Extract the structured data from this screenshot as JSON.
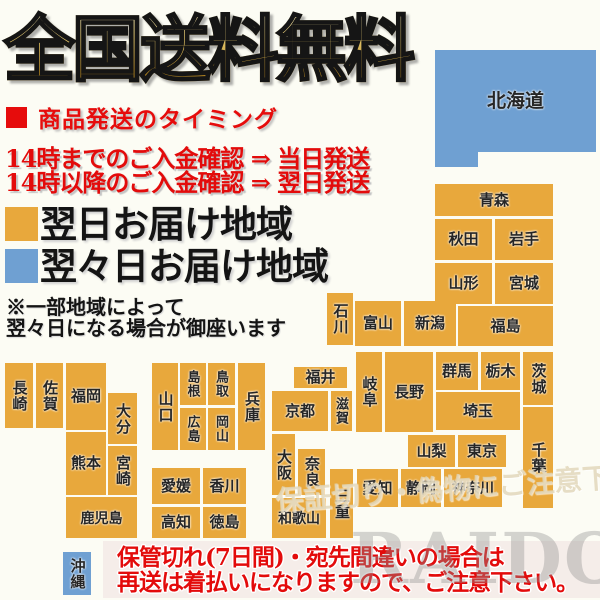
{
  "title": "全国送料無料",
  "shipping": {
    "header": "商品発送のタイミング",
    "lines": [
      "14時までのご入金確認 ⇒ 当日発送",
      "14時以降のご入金確認 ⇒ 翌日発送"
    ]
  },
  "legend": {
    "next_day": {
      "label": "翌日お届け地域",
      "color": "#E8A83C"
    },
    "two_days": {
      "label": "翌々日お届け地域",
      "color": "#6FA0D2"
    }
  },
  "note": {
    "line1": "※一部地域によって",
    "line2": "翌々日になる場合が御座います"
  },
  "warning": {
    "line1": "保管切れ(7日間)・宛先間違いの場合は",
    "line2": "再送は着払いになりますので、ご注意下さい。"
  },
  "watermarks": {
    "caution": "保証切り・偽物にご注意下さい",
    "brand": "RAIDOU"
  },
  "colors": {
    "orange": "#E8A83C",
    "blue": "#6FA0D2",
    "background": "#FCFCF4",
    "red": "#E30B0B"
  },
  "map": {
    "blocks": [
      {
        "id": "hokkaido",
        "label": "北海道",
        "x": 435,
        "y": 50,
        "w": 161,
        "h": 102,
        "c": "blue",
        "fs": 19
      },
      {
        "id": "hokkaido-leg",
        "label": "",
        "x": 435,
        "y": 150,
        "w": 43,
        "h": 17,
        "c": "blue"
      },
      {
        "id": "aomori",
        "label": "青森",
        "x": 435,
        "y": 184,
        "w": 118,
        "h": 32,
        "c": "orange"
      },
      {
        "id": "akita",
        "label": "秋田",
        "x": 435,
        "y": 219,
        "w": 57,
        "h": 41,
        "c": "orange"
      },
      {
        "id": "iwate",
        "label": "岩手",
        "x": 495,
        "y": 219,
        "w": 58,
        "h": 41,
        "c": "orange"
      },
      {
        "id": "yamagata",
        "label": "山形",
        "x": 435,
        "y": 263,
        "w": 57,
        "h": 41,
        "c": "orange"
      },
      {
        "id": "miyagi",
        "label": "宮城",
        "x": 495,
        "y": 263,
        "w": 58,
        "h": 41,
        "c": "orange"
      },
      {
        "id": "fukushima",
        "label": "福島",
        "x": 458,
        "y": 306,
        "w": 95,
        "h": 40,
        "c": "orange"
      },
      {
        "id": "niigata",
        "label": "新潟",
        "x": 404,
        "y": 301,
        "w": 52,
        "h": 45,
        "c": "orange"
      },
      {
        "id": "ishikawa",
        "label": "石川",
        "x": 327,
        "y": 293,
        "w": 26,
        "h": 52,
        "c": "orange",
        "v": true
      },
      {
        "id": "toyama",
        "label": "富山",
        "x": 355,
        "y": 301,
        "w": 46,
        "h": 45,
        "c": "orange"
      },
      {
        "id": "fukui",
        "label": "福井",
        "x": 294,
        "y": 367,
        "w": 53,
        "h": 21,
        "c": "orange"
      },
      {
        "id": "kyoto",
        "label": "京都",
        "x": 272,
        "y": 391,
        "w": 56,
        "h": 40,
        "c": "orange"
      },
      {
        "id": "shiga",
        "label": "滋賀",
        "x": 331,
        "y": 391,
        "w": 21,
        "h": 40,
        "c": "orange",
        "v": true,
        "fs": 13
      },
      {
        "id": "gifu",
        "label": "岐阜",
        "x": 356,
        "y": 352,
        "w": 26,
        "h": 80,
        "c": "orange",
        "v": true
      },
      {
        "id": "nagano",
        "label": "長野",
        "x": 385,
        "y": 352,
        "w": 48,
        "h": 80,
        "c": "orange"
      },
      {
        "id": "gunma",
        "label": "群馬",
        "x": 436,
        "y": 352,
        "w": 42,
        "h": 38,
        "c": "orange"
      },
      {
        "id": "tochigi",
        "label": "栃木",
        "x": 481,
        "y": 352,
        "w": 39,
        "h": 38,
        "c": "orange"
      },
      {
        "id": "ibaraki",
        "label": "茨城",
        "x": 523,
        "y": 352,
        "w": 30,
        "h": 53,
        "c": "orange",
        "v": true
      },
      {
        "id": "saitama",
        "label": "埼玉",
        "x": 436,
        "y": 392,
        "w": 84,
        "h": 38,
        "c": "orange"
      },
      {
        "id": "yamanashi",
        "label": "山梨",
        "x": 408,
        "y": 435,
        "w": 47,
        "h": 32,
        "c": "orange"
      },
      {
        "id": "tokyo",
        "label": "東京",
        "x": 458,
        "y": 435,
        "w": 48,
        "h": 32,
        "c": "orange"
      },
      {
        "id": "chiba",
        "label": "千葉",
        "x": 523,
        "y": 407,
        "w": 30,
        "h": 101,
        "c": "orange",
        "v": true
      },
      {
        "id": "kanagawa",
        "label": "神奈川",
        "x": 444,
        "y": 469,
        "w": 58,
        "h": 38,
        "c": "orange",
        "fs": 14
      },
      {
        "id": "shizuoka",
        "label": "静岡",
        "x": 401,
        "y": 469,
        "w": 40,
        "h": 38,
        "c": "orange"
      },
      {
        "id": "aichi",
        "label": "愛知",
        "x": 357,
        "y": 469,
        "w": 41,
        "h": 38,
        "c": "orange"
      },
      {
        "id": "mie",
        "label": "三重",
        "x": 330,
        "y": 469,
        "w": 23,
        "h": 69,
        "c": "orange",
        "v": true
      },
      {
        "id": "osaka",
        "label": "大阪",
        "x": 272,
        "y": 434,
        "w": 23,
        "h": 61,
        "c": "orange",
        "v": true
      },
      {
        "id": "nara",
        "label": "奈良",
        "x": 298,
        "y": 449,
        "w": 27,
        "h": 46,
        "c": "orange",
        "v": true
      },
      {
        "id": "wakayama",
        "label": "和歌山",
        "x": 272,
        "y": 498,
        "w": 54,
        "h": 40,
        "c": "orange",
        "fs": 14
      },
      {
        "id": "hyogo",
        "label": "兵庫",
        "x": 238,
        "y": 363,
        "w": 27,
        "h": 87,
        "c": "orange",
        "v": true
      },
      {
        "id": "tottori",
        "label": "鳥取",
        "x": 208,
        "y": 363,
        "w": 27,
        "h": 42,
        "c": "orange",
        "v": true,
        "fs": 13
      },
      {
        "id": "okayama",
        "label": "岡山",
        "x": 208,
        "y": 408,
        "w": 27,
        "h": 42,
        "c": "orange",
        "v": true,
        "fs": 13
      },
      {
        "id": "shimane",
        "label": "島根",
        "x": 180,
        "y": 363,
        "w": 26,
        "h": 42,
        "c": "orange",
        "v": true,
        "fs": 13
      },
      {
        "id": "hiroshima",
        "label": "広島",
        "x": 180,
        "y": 408,
        "w": 26,
        "h": 42,
        "c": "orange",
        "v": true,
        "fs": 13
      },
      {
        "id": "yamaguchi",
        "label": "山口",
        "x": 152,
        "y": 363,
        "w": 26,
        "h": 87,
        "c": "orange",
        "v": true
      },
      {
        "id": "ehime",
        "label": "愛媛",
        "x": 152,
        "y": 468,
        "w": 48,
        "h": 36,
        "c": "orange"
      },
      {
        "id": "kagawa",
        "label": "香川",
        "x": 203,
        "y": 468,
        "w": 43,
        "h": 36,
        "c": "orange"
      },
      {
        "id": "kochi",
        "label": "高知",
        "x": 152,
        "y": 507,
        "w": 48,
        "h": 31,
        "c": "orange"
      },
      {
        "id": "tokushima",
        "label": "徳島",
        "x": 203,
        "y": 507,
        "w": 43,
        "h": 31,
        "c": "orange"
      },
      {
        "id": "nagasaki",
        "label": "長崎",
        "x": 5,
        "y": 363,
        "w": 28,
        "h": 65,
        "c": "orange",
        "v": true
      },
      {
        "id": "saga",
        "label": "佐賀",
        "x": 36,
        "y": 363,
        "w": 27,
        "h": 65,
        "c": "orange",
        "v": true
      },
      {
        "id": "fukuoka",
        "label": "福岡",
        "x": 66,
        "y": 363,
        "w": 40,
        "h": 67,
        "c": "orange"
      },
      {
        "id": "oita",
        "label": "大分",
        "x": 108,
        "y": 393,
        "w": 29,
        "h": 51,
        "c": "orange",
        "v": true
      },
      {
        "id": "kumamoto",
        "label": "熊本",
        "x": 66,
        "y": 432,
        "w": 40,
        "h": 63,
        "c": "orange"
      },
      {
        "id": "miyazaki",
        "label": "宮崎",
        "x": 108,
        "y": 446,
        "w": 29,
        "h": 49,
        "c": "orange",
        "v": true
      },
      {
        "id": "kagoshima",
        "label": "鹿児島",
        "x": 66,
        "y": 497,
        "w": 71,
        "h": 41,
        "c": "orange",
        "fs": 14
      },
      {
        "id": "okinawa",
        "label": "沖縄",
        "x": 63,
        "y": 552,
        "w": 28,
        "h": 43,
        "c": "blue",
        "v": true
      }
    ]
  }
}
